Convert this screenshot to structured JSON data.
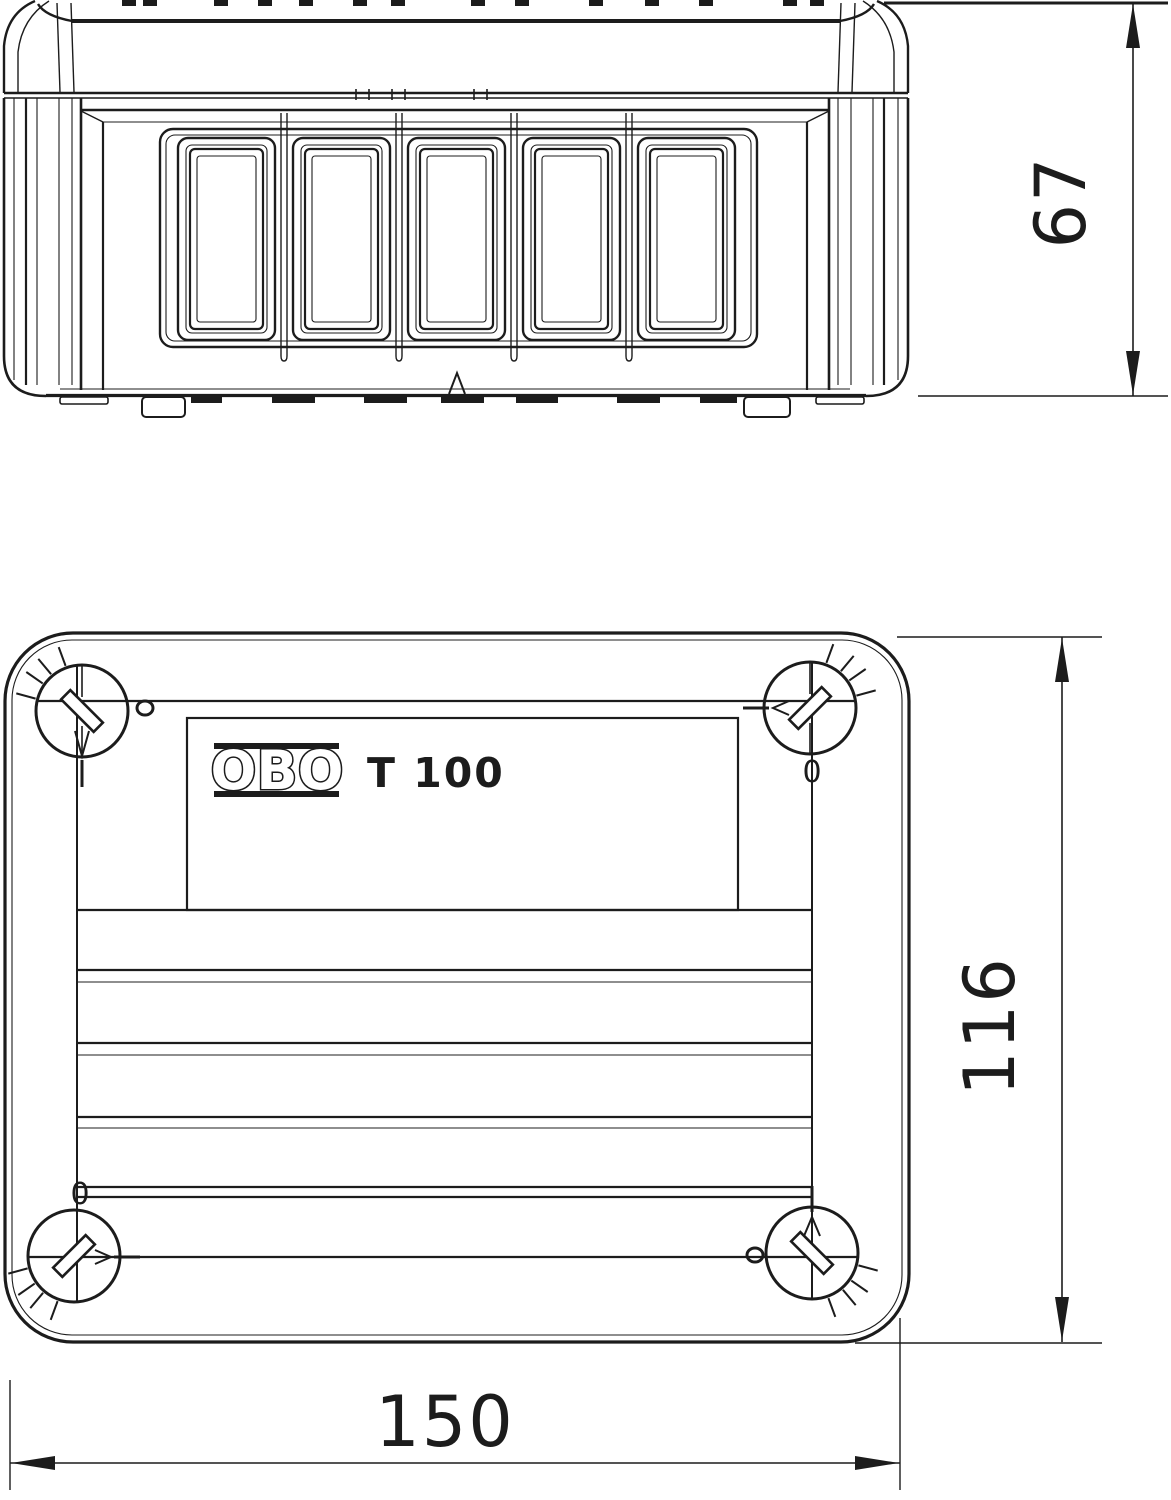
{
  "colors": {
    "line": "#1c1c1c",
    "background": "#ffffff"
  },
  "dimensions": {
    "height": {
      "value": "67"
    },
    "depth": {
      "value": "116"
    },
    "width": {
      "value": "150"
    }
  },
  "plan_view": {
    "logo_text": "OBO",
    "product_label": "T 100",
    "screw_marker_top_right": "0",
    "screw_marker_bottom_left": "0"
  }
}
